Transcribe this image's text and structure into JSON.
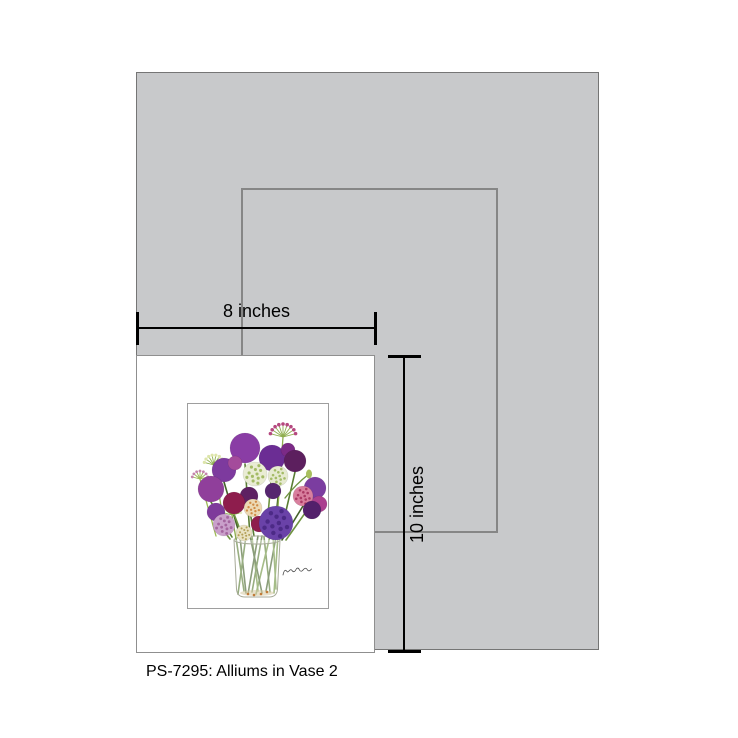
{
  "caption": "PS-7295: Alliums in Vase 2",
  "dimension_labels": {
    "width": "8 inches",
    "height": "10 inches"
  },
  "colors": {
    "backdrop_fill": "#c8c9cb",
    "backdrop_border": "#757575",
    "size_outline_border": "#868686",
    "dimension_line": "#000000",
    "mat_fill": "#ffffff",
    "mat_border": "#8f8f8f",
    "artwork_frame_border": "#9e9e9e"
  },
  "artwork": {
    "name": "alliums-in-vase-watercolor",
    "viewbox": "0 0 140 204",
    "stem_colors": [
      "#5a7d34",
      "#6f9440",
      "#44622a"
    ],
    "stems": [
      [
        57,
        60,
        62,
        132
      ],
      [
        84,
        67,
        78,
        132
      ],
      [
        36,
        78,
        52,
        132
      ],
      [
        23,
        98,
        44,
        133
      ],
      [
        46,
        110,
        55,
        133
      ],
      [
        95,
        47,
        86,
        131
      ],
      [
        107,
        68,
        92,
        133
      ],
      [
        127,
        95,
        98,
        136
      ],
      [
        115,
        102,
        94,
        136
      ],
      [
        61,
        101,
        66,
        132
      ],
      [
        28,
        117,
        42,
        135
      ],
      [
        52,
        133,
        58,
        189
      ],
      [
        58,
        132,
        50,
        190
      ],
      [
        64,
        133,
        70,
        187
      ],
      [
        70,
        132,
        60,
        190
      ],
      [
        76,
        133,
        82,
        188
      ],
      [
        82,
        132,
        68,
        190
      ],
      [
        88,
        133,
        78,
        187
      ],
      [
        48,
        134,
        56,
        187
      ],
      [
        90,
        132,
        86,
        189
      ],
      [
        62,
        132,
        74,
        189
      ],
      [
        74,
        132,
        64,
        188
      ],
      [
        85,
        132,
        88,
        185
      ]
    ],
    "bursts": [
      {
        "cx": 95,
        "cy": 33,
        "len": 13,
        "rays": 9,
        "ray_color": "#8fae4e",
        "tip_color": "#b5487f",
        "tip_r": 1.8,
        "stalk": [
          88,
          131
        ]
      },
      {
        "cx": 26,
        "cy": 61,
        "len": 10,
        "rays": 8,
        "ray_color": "#8fae4e",
        "tip_color": "#dde5ab",
        "tip_r": 1.6,
        "stalk": [
          38,
          131
        ]
      },
      {
        "cx": 12,
        "cy": 75,
        "len": 8,
        "rays": 7,
        "ray_color": "#9db954",
        "tip_color": "#c585ad",
        "tip_r": 1.4,
        "stalk": [
          28,
          132
        ]
      },
      {
        "cx": 44,
        "cy": 111,
        "len": 9,
        "rays": 8,
        "ray_color": "#8fae4e",
        "tip_color": "#e6ecc4",
        "tip_r": 1.5,
        "stalk": [
          48,
          135
        ]
      }
    ],
    "bud": {
      "path": "M121,70 Q108,80 97,94",
      "stroke": "#6f9440",
      "cx": 121,
      "cy": 70,
      "rx": 3,
      "ry": 4.5,
      "fill": "#a8bf5e"
    },
    "vase": {
      "body": "M46,136 L48.5,185 Q49,193 57,193 L81,193 Q89,193 89.5,185 L92,136",
      "rim": [
        69,
        136,
        23,
        4
      ],
      "stroke": "#a7aa98",
      "glass_fill": "rgba(255,255,255,0.38)",
      "shade": [
        69,
        189,
        17,
        3
      ],
      "shade_color": "rgba(214,200,160,0.55)",
      "dots": [
        [
          60,
          190
        ],
        [
          66,
          191
        ],
        [
          73,
          190
        ],
        [
          79,
          188
        ]
      ],
      "dot_color": "#c07a38"
    },
    "poms": [
      {
        "cx": 57,
        "cy": 44,
        "r": 15,
        "fill": "#8a3da5"
      },
      {
        "cx": 84,
        "cy": 54,
        "r": 13,
        "fill": "#6b2d94"
      },
      {
        "cx": 100,
        "cy": 46,
        "r": 7,
        "fill": "#7b2a86"
      },
      {
        "cx": 107,
        "cy": 57,
        "r": 11,
        "fill": "#5c1f5e"
      },
      {
        "cx": 36,
        "cy": 66,
        "r": 12,
        "fill": "#7d3a9e"
      },
      {
        "cx": 47,
        "cy": 59,
        "r": 7,
        "fill": "#a44b9b"
      },
      {
        "cx": 67,
        "cy": 70,
        "r": 12,
        "fill": "#e9ecd4",
        "speck": "#a4bb66"
      },
      {
        "cx": 90,
        "cy": 72,
        "r": 10,
        "fill": "#e6ead0",
        "speck": "#a4bb66"
      },
      {
        "cx": 85,
        "cy": 87,
        "r": 8,
        "fill": "#56266f"
      },
      {
        "cx": 23,
        "cy": 85,
        "r": 13,
        "fill": "#903f9b"
      },
      {
        "cx": 127,
        "cy": 84,
        "r": 11,
        "fill": "#7b3da0"
      },
      {
        "cx": 115,
        "cy": 92,
        "r": 10,
        "fill": "#d87f9e",
        "speck": "#ab3a64"
      },
      {
        "cx": 61,
        "cy": 92,
        "r": 9,
        "fill": "#5e2162"
      },
      {
        "cx": 46,
        "cy": 99,
        "r": 11,
        "fill": "#8e1d4d"
      },
      {
        "cx": 131,
        "cy": 100,
        "r": 8,
        "fill": "#aa3f8f"
      },
      {
        "cx": 28,
        "cy": 108,
        "r": 9,
        "fill": "#7e3a9b"
      },
      {
        "cx": 65,
        "cy": 104,
        "r": 9,
        "fill": "#ecd9b4",
        "speck": "#cf8b45"
      },
      {
        "cx": 124,
        "cy": 106,
        "r": 9,
        "fill": "#53206b"
      },
      {
        "cx": 71,
        "cy": 120,
        "r": 8,
        "fill": "#8e1d4d"
      },
      {
        "cx": 36,
        "cy": 121,
        "r": 11,
        "fill": "#c9a0ca",
        "speck": "#a4669f"
      },
      {
        "cx": 56,
        "cy": 129,
        "r": 8,
        "fill": "#e9e2c2",
        "speck": "#b3a058"
      },
      {
        "cx": 88,
        "cy": 119,
        "r": 17,
        "fill": "#6a42a8",
        "speck": "#4c2a86"
      }
    ],
    "signature": {
      "d": "M95,171 q1.5,-7 4,-3.5 c1.5,2 3,-4 5,-1 c1,1.5 2.5,2 4,-1 c1,-2 2.5,-2 3.5,0.5 c1,2 2.5,1.5 4,-0.5 c1.5,-2 3,-1.5 4,0.5 c1,1.5 2.5,1 4,-1",
      "stroke": "#4a4a4a",
      "width": 0.8
    }
  }
}
